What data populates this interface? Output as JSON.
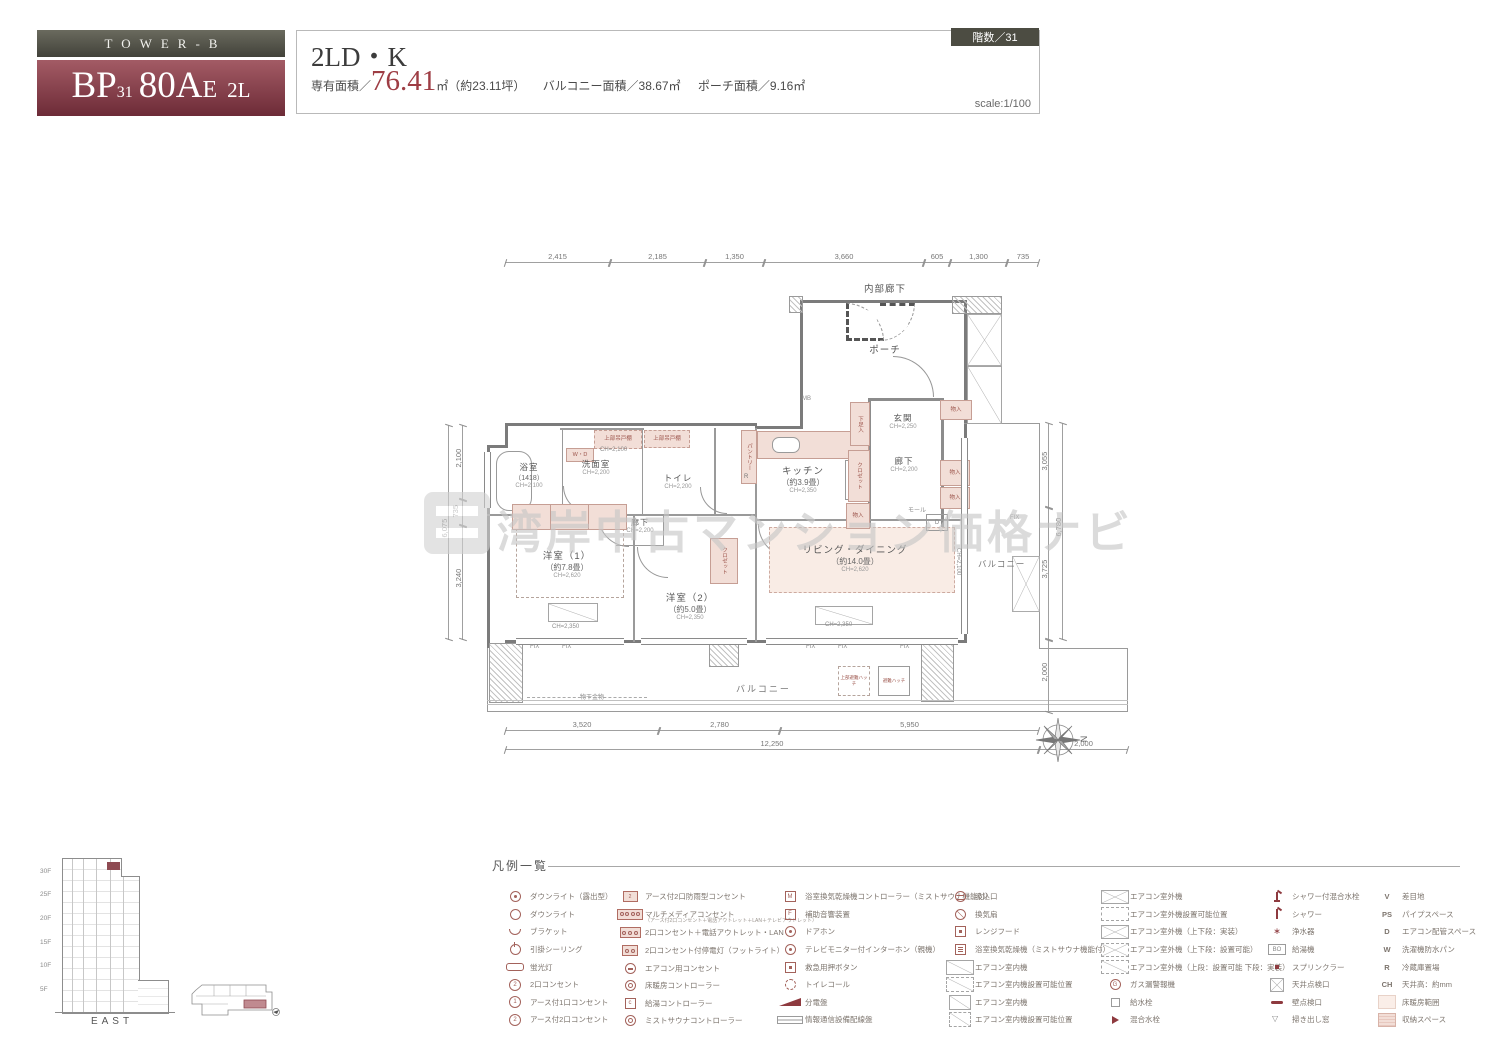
{
  "header": {
    "tower": "TOWER-B",
    "unit_bp": "BP",
    "unit_31": "31",
    "unit_80a": "80A",
    "unit_e": "E",
    "unit_2l": "2L",
    "plan_type": "2LD・K",
    "area_label": "専有面積／",
    "area_value": "76.41",
    "area_unit": "㎡",
    "area_tsubo": "（約23.11坪）",
    "balcony_area": "バルコニー面積／38.67㎡",
    "porch_area": "ポーチ面積／9.16㎡",
    "scale": "scale:1/100",
    "floor_badge": "階数／31"
  },
  "watermark": {
    "text": "湾岸中古マンション価格ナビ"
  },
  "colors": {
    "brand_maroon": "#7d2f3b",
    "header_olive": "#4c4c42",
    "fixture_pink": "#f2ded7"
  },
  "plan": {
    "corridor_top": "内部廊下",
    "porch": "ポーチ",
    "mb": "MB",
    "genkan": {
      "name": "玄関",
      "ch": "CH=2,250"
    },
    "hall_entry": {
      "name": "廊下",
      "ch": "CH=2,200"
    },
    "hall_inner": {
      "name": "廊下",
      "ch": "CH=2,200"
    },
    "kitchen": {
      "name": "キッチン",
      "size": "（約3.9畳）",
      "ch": "CH=2,350"
    },
    "bath": {
      "name": "浴室",
      "size": "（1418）",
      "ch": "CH=2,100"
    },
    "wash": {
      "name": "洗面室",
      "ch": "CH=2,200",
      "ch2": "CH=2,100"
    },
    "toilet": {
      "name": "トイレ",
      "ch": "CH=2,200"
    },
    "west1": {
      "name": "洋室（1）",
      "size": "（約7.8畳）",
      "ch": "CH=2,620",
      "ch2": "CH=2,350"
    },
    "west2": {
      "name": "洋室（2）",
      "size": "（約5.0畳）",
      "ch": "CH=2,350"
    },
    "living": {
      "name": "リビング・ダイニング",
      "size": "（約14.0畳）",
      "ch": "CH=2,620",
      "ch2": "CH=2,350",
      "ch3": "CH=2,100"
    },
    "balcony_right": "バルコニー",
    "balcony_bottom": "バルコニー",
    "monohoshi": "物干金物",
    "hatch_upper": "上部避難ハッチ",
    "hatch": "避難ハッチ",
    "fix": "FIX",
    "storage": "物入",
    "closet": "クロゼット",
    "shoe": "下足入",
    "pantry": "パントリー",
    "hang_cab": "上部吊戸棚",
    "wd": "W・D",
    "mall": "モール",
    "d": "D",
    "r": "R",
    "dims_top": [
      "2,415",
      "2,185",
      "1,350",
      "3,660",
      "605",
      "1,300",
      "735"
    ],
    "dims_bottom1": [
      "3,520",
      "2,780",
      "5,950"
    ],
    "dims_bottom2": [
      "12,250",
      "2,000"
    ],
    "dims_left": [
      "2,100",
      "735",
      "3,240"
    ],
    "dims_left_outer": "6,075",
    "dims_right": [
      "3,055",
      "3,725",
      "2,000"
    ],
    "dims_right_outer": "6,780",
    "compass_n": "N"
  },
  "elevation": {
    "floors": [
      "30F",
      "25F",
      "20F",
      "15F",
      "10F",
      "5F"
    ],
    "label": "EAST"
  },
  "legend": {
    "title": "凡例一覧",
    "columns": [
      {
        "items": [
          {
            "t": "cd",
            "l": "ダウンライト（露出型）"
          },
          {
            "t": "c",
            "l": "ダウンライト"
          },
          {
            "t": "half",
            "l": "ブラケット"
          },
          {
            "t": "c2",
            "l": "引掛シーリング"
          },
          {
            "t": "fluo",
            "l": "蛍光灯"
          },
          {
            "t": "cnum",
            "x": "2",
            "l": "2口コンセント"
          },
          {
            "t": "ce",
            "x": "1",
            "l": "アース付1口コンセント"
          },
          {
            "t": "ce",
            "x": "2",
            "l": "アース付2口コンセント"
          }
        ]
      },
      {
        "items": [
          {
            "t": "pb",
            "x": "2",
            "l": "アース付2口防雨型コンセント"
          },
          {
            "t": "m4",
            "l": "マルチメディアコンセント",
            "sub": "（アース付2口コンセント＋電話アウトレット＋LAN＋テレビアウトレット）"
          },
          {
            "t": "m3",
            "l": "2口コンセント＋電話アウトレット・LAN"
          },
          {
            "t": "m2",
            "l": "2口コンセント付停電灯（フットライト）"
          },
          {
            "t": "ac",
            "l": "エアコン用コンセント"
          },
          {
            "t": "cc",
            "l": "床暖房コントローラー"
          },
          {
            "t": "bxc",
            "x": "c",
            "l": "給湯コントローラー"
          },
          {
            "t": "cc",
            "l": "ミストサウナコントローラー"
          }
        ]
      },
      {
        "items": [
          {
            "t": "bx",
            "x": "M",
            "l": "浴室換気乾燥機コントローラー（ミストサウナ機能付）"
          },
          {
            "t": "bx",
            "x": "F",
            "l": "補助音響装置"
          },
          {
            "t": "cd",
            "l": "ドアホン"
          },
          {
            "t": "cd",
            "l": "テレビモニター付インターホン（親機）"
          },
          {
            "t": "bxd",
            "l": "救急用押ボタン"
          },
          {
            "t": "cdash",
            "l": "トイレコール"
          },
          {
            "t": "wedge",
            "l": "分電盤"
          },
          {
            "t": "bar",
            "l": "情報通信設備配線盤"
          }
        ]
      },
      {
        "items": [
          {
            "t": "csl",
            "l": "吸込口"
          },
          {
            "t": "cx",
            "l": "換気扇"
          },
          {
            "t": "bxd",
            "l": "レンジフード"
          },
          {
            "t": "bxm",
            "l": "浴室換気乾燥機（ミストサウナ機能付）"
          },
          {
            "t": "diag",
            "l": "エアコン室内機"
          },
          {
            "t": "diagd",
            "l": "エアコン室内機設置可能位置"
          },
          {
            "t": "diag2",
            "l": "エアコン室内機"
          },
          {
            "t": "diag2d",
            "l": "エアコン室内機設置可能位置"
          }
        ]
      },
      {
        "items": [
          {
            "t": "xb",
            "l": "エアコン室外機"
          },
          {
            "t": "xbd",
            "l": "エアコン室外機設置可能位置"
          },
          {
            "t": "xb2",
            "l": "エアコン室外機（上下段：実装）"
          },
          {
            "t": "xb2d",
            "l": "エアコン室外機（上下段：設置可能）"
          },
          {
            "t": "xbh",
            "l": "エアコン室外機（上段：設置可能 下段：実装）"
          },
          {
            "t": "cg",
            "x": "G",
            "l": "ガス漏警報機"
          },
          {
            "t": "sq",
            "l": "給水栓"
          },
          {
            "t": "tri",
            "l": "混合水栓"
          }
        ]
      },
      {
        "items": [
          {
            "t": "shw",
            "l": "シャワー付混合水栓"
          },
          {
            "t": "shw2",
            "l": "シャワー"
          },
          {
            "t": "star",
            "x": "∗",
            "l": "浄水器"
          },
          {
            "t": "bo",
            "x": "BO",
            "l": "給湯機"
          },
          {
            "t": "dot",
            "l": "スプリンクラー"
          },
          {
            "t": "xbg",
            "l": "天井点検口"
          },
          {
            "t": "dash",
            "l": "壁点検口"
          },
          {
            "t": "vtri",
            "l": "掃き出し窓"
          }
        ]
      },
      {
        "items": [
          {
            "t": "ltr",
            "x": "V",
            "l": "差目地"
          },
          {
            "t": "ltr",
            "x": "PS",
            "l": "パイプスペース"
          },
          {
            "t": "ltr",
            "x": "D",
            "l": "エアコン配管スペース"
          },
          {
            "t": "ltr",
            "x": "W",
            "l": "洗濯機防水パン"
          },
          {
            "t": "ltr",
            "x": "R",
            "l": "冷蔵庫置場"
          },
          {
            "t": "ltr",
            "x": "CH",
            "l": "天井高：約mm"
          },
          {
            "t": "fh",
            "l": "床暖房範囲"
          },
          {
            "t": "st",
            "l": "収納スペース"
          }
        ]
      }
    ]
  }
}
